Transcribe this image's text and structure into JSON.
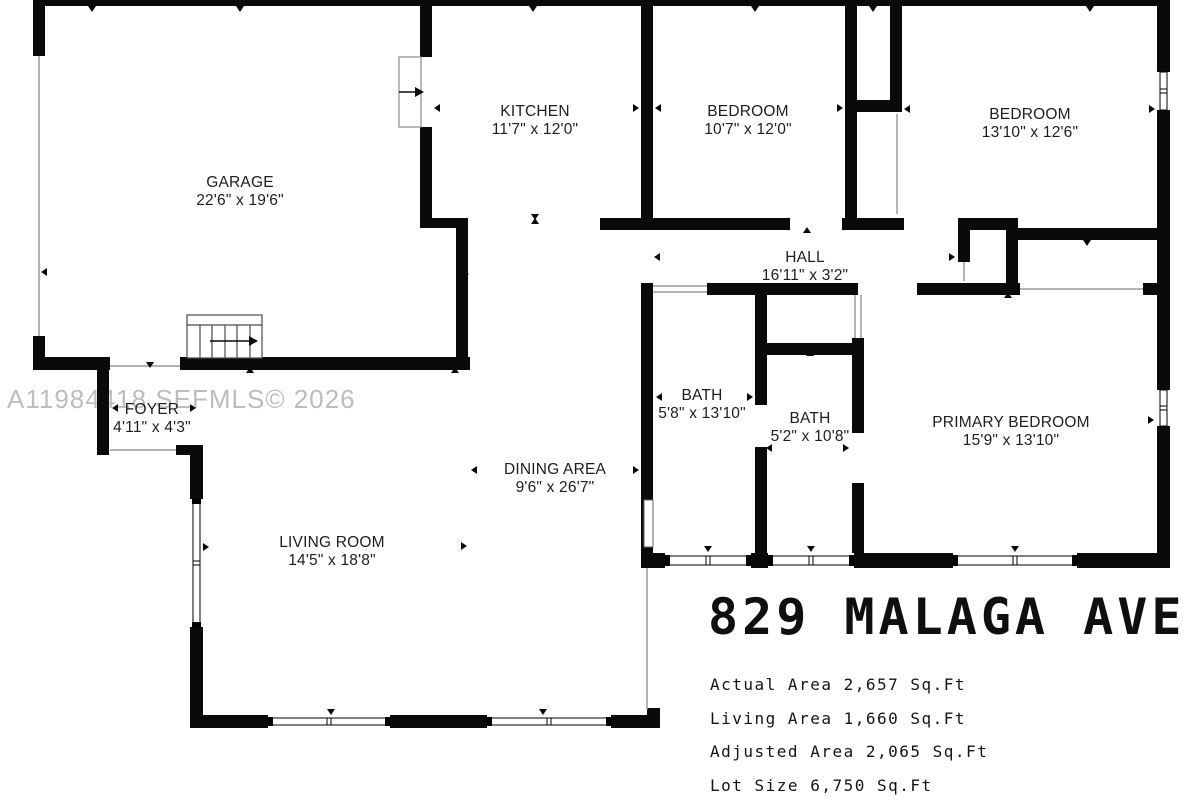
{
  "floorplan": {
    "watermark": "A11984418 SEFMLS© 2026",
    "title": "829 MALAGA AVE",
    "stats": [
      "Actual Area 2,657 Sq.Ft",
      "Living Area 1,660 Sq.Ft",
      "Adjusted Area 2,065 Sq.Ft",
      "Lot Size 6,750 Sq.Ft"
    ],
    "rooms": [
      {
        "name": "GARAGE",
        "dims": "22'6\" x 19'6\""
      },
      {
        "name": "KITCHEN",
        "dims": "11'7\" x 12'0\""
      },
      {
        "name": "BEDROOM",
        "dims": "10'7\" x 12'0\""
      },
      {
        "name": "BEDROOM",
        "dims": "13'10\" x 12'6\""
      },
      {
        "name": "HALL",
        "dims": "16'11\" x 3'2\""
      },
      {
        "name": "FOYER",
        "dims": "4'11\" x 4'3\""
      },
      {
        "name": "BATH",
        "dims": "5'8\" x 13'10\""
      },
      {
        "name": "BATH",
        "dims": "5'2\" x 10'8\""
      },
      {
        "name": "PRIMARY BEDROOM",
        "dims": "15'9\" x 13'10\""
      },
      {
        "name": "DINING AREA",
        "dims": "9'6\" x 26'7\""
      },
      {
        "name": "LIVING ROOM",
        "dims": "14'5\" x 18'8\""
      }
    ],
    "colors": {
      "wall": "#0a0a0a",
      "label_text": "#1d1d1d",
      "title_text": "#0f0f0f",
      "watermark": "#bdbdbd"
    }
  }
}
